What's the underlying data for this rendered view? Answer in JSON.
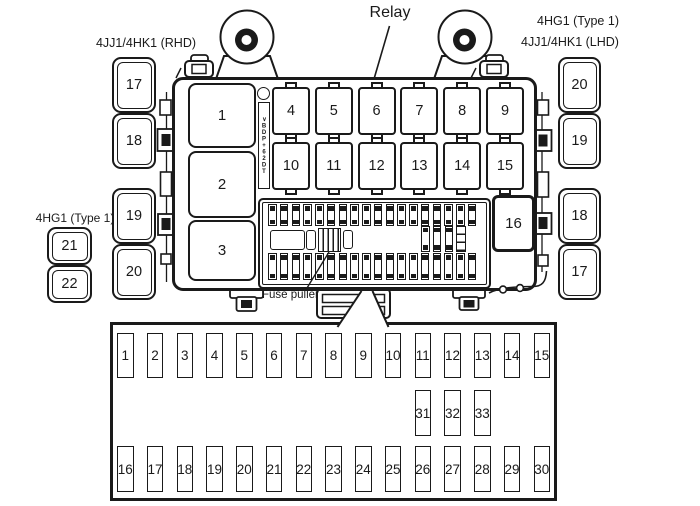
{
  "labels": {
    "relay": "Relay",
    "variant_top_right_line1": "4HG1 (Type 1)",
    "variant_top_right_line2": "4JJ1/4HK1 (LHD)",
    "variant_top_left": "4JJ1/4HK1 (RHD)",
    "variant_mid_left": "4HG1 (Type 1)",
    "fuse_puller": "Fuse puller",
    "connector_strip": "∨BDP+62DT"
  },
  "side_groups": {
    "left_top": [
      "17",
      "18"
    ],
    "left_mid": [
      "19",
      "20"
    ],
    "left_bottom": [
      "21",
      "22"
    ],
    "right_top": [
      "20",
      "19"
    ],
    "right_bottom": [
      "18",
      "17"
    ]
  },
  "main_box": {
    "large_relays": [
      "1",
      "2",
      "3"
    ],
    "relay_row_1": [
      "4",
      "5",
      "6",
      "7",
      "8",
      "9"
    ],
    "relay_row_2": [
      "10",
      "11",
      "12",
      "13",
      "14",
      "15"
    ],
    "corner_relay": "16"
  },
  "detail_box": {
    "row_top": [
      "1",
      "2",
      "3",
      "4",
      "5",
      "6",
      "7",
      "8",
      "9",
      "10",
      "11",
      "12",
      "13",
      "14",
      "15"
    ],
    "row_mid": [
      "31",
      "32",
      "33"
    ],
    "row_bottom": [
      "16",
      "17",
      "18",
      "19",
      "20",
      "21",
      "22",
      "23",
      "24",
      "25",
      "26",
      "27",
      "28",
      "29",
      "30"
    ]
  },
  "colors": {
    "ink": "#1a1a1a",
    "paper": "#ffffff"
  }
}
